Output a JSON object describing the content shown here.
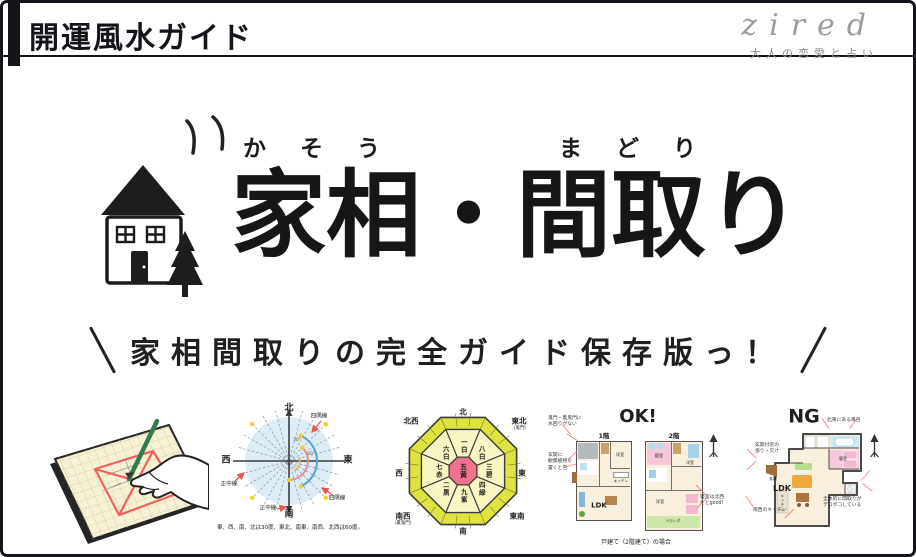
{
  "header": {
    "site_title": "開運風水ガイド",
    "logo_text": "zired",
    "logo_tagline": "大人の恋愛と占い"
  },
  "hero": {
    "furigana_kaso": "かそう",
    "furigana_madori": "まどり",
    "title": "家相・間取り",
    "catchcopy": "家相間取りの完全ガイド保存版っ！"
  },
  "compass": {
    "north": "北",
    "south": "南",
    "east": "東",
    "west": "西",
    "label_yosumi": "四隅線",
    "label_seichu": "正中線",
    "deg30": "30°",
    "deg60": "60°",
    "caption": "東、西、南、北は30度、東北、南東、南西、北西は60度。"
  },
  "kyusei": {
    "center": "五黄",
    "sectors": [
      "一白",
      "八白",
      "三碧",
      "四緑",
      "九紫",
      "二黒",
      "七赤",
      "六白"
    ],
    "dirs": {
      "n": "北",
      "ne": "東北",
      "e": "東",
      "se": "東南",
      "s": "南",
      "sw": "南西",
      "w": "西",
      "nw": "北西"
    },
    "kimon": "（鬼門）",
    "urakimon": "（裏鬼門）"
  },
  "ok_plan": {
    "title": "OK!",
    "floor1": "1階",
    "floor2": "2階",
    "ldk": "LDK",
    "rooms": {
      "yoshitsu": "洋室",
      "shinshitsu": "寝室",
      "kitchen": "キッチン",
      "veranda": "ベランダ"
    },
    "ann_kimon": "鬼門・裏鬼門に\n水回りがない",
    "ann_genkan": "玄関に\n観葉植物を\n置くと吉",
    "ann_bedroom": "寝室は北西\nだとgood!",
    "caption": "戸建て（2階建て）の場合"
  },
  "ng_plan": {
    "title": "NG",
    "ldk": "LDK",
    "rooms": {
      "shinshitsu": "寝室",
      "kitchen": "キッチン",
      "genkan": "玄関"
    },
    "ann_bath": "北東にある風呂",
    "ann_genkan": "玄関付近の\n張り・欠け",
    "ann_kitchen": "南西のキッチン",
    "ann_shape": "全体的に間取りが\nデコボコしている"
  }
}
